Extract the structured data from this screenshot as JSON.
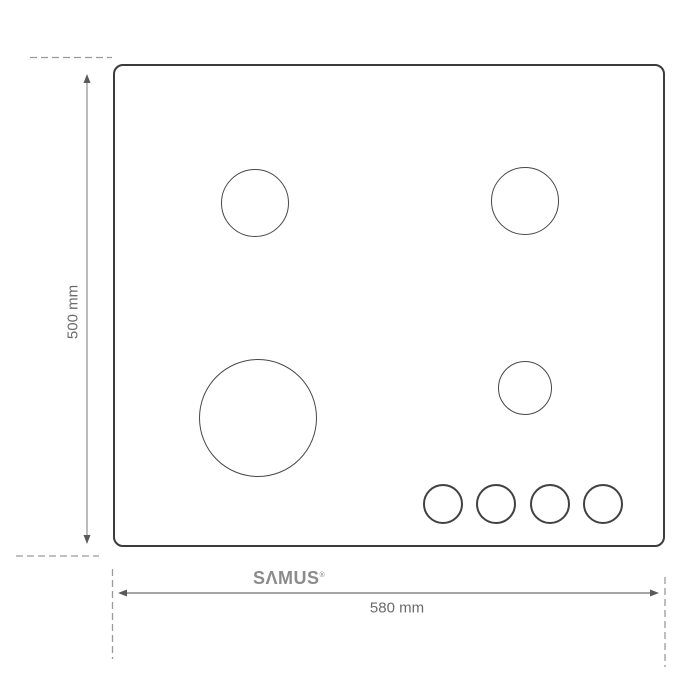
{
  "diagram": {
    "type": "product-dimension-diagram",
    "subject": "4-burner gas hob top view",
    "brand": {
      "name": "SΛMUS",
      "mark": "®"
    },
    "vertical_dimension": {
      "label": "500 mm",
      "value": 500,
      "unit": "mm"
    },
    "horizontal_dimension": {
      "label": "580 mm",
      "value": 580,
      "unit": "mm"
    },
    "burners": [
      {
        "id": "burner-top-left",
        "size": "medium"
      },
      {
        "id": "burner-top-right",
        "size": "medium"
      },
      {
        "id": "burner-bottom-left",
        "size": "large"
      },
      {
        "id": "burner-mid-right",
        "size": "small"
      }
    ],
    "knobs_count": 4,
    "colors": {
      "background": "#ffffff",
      "hob_outline": "#3c3c3c",
      "burner_outline": "#474747",
      "dimension_line": "#9e9e9e",
      "dashed_line": "#9a9a9a",
      "label_text": "#6b6b6b",
      "logo_text": "#8c8c8c"
    }
  }
}
